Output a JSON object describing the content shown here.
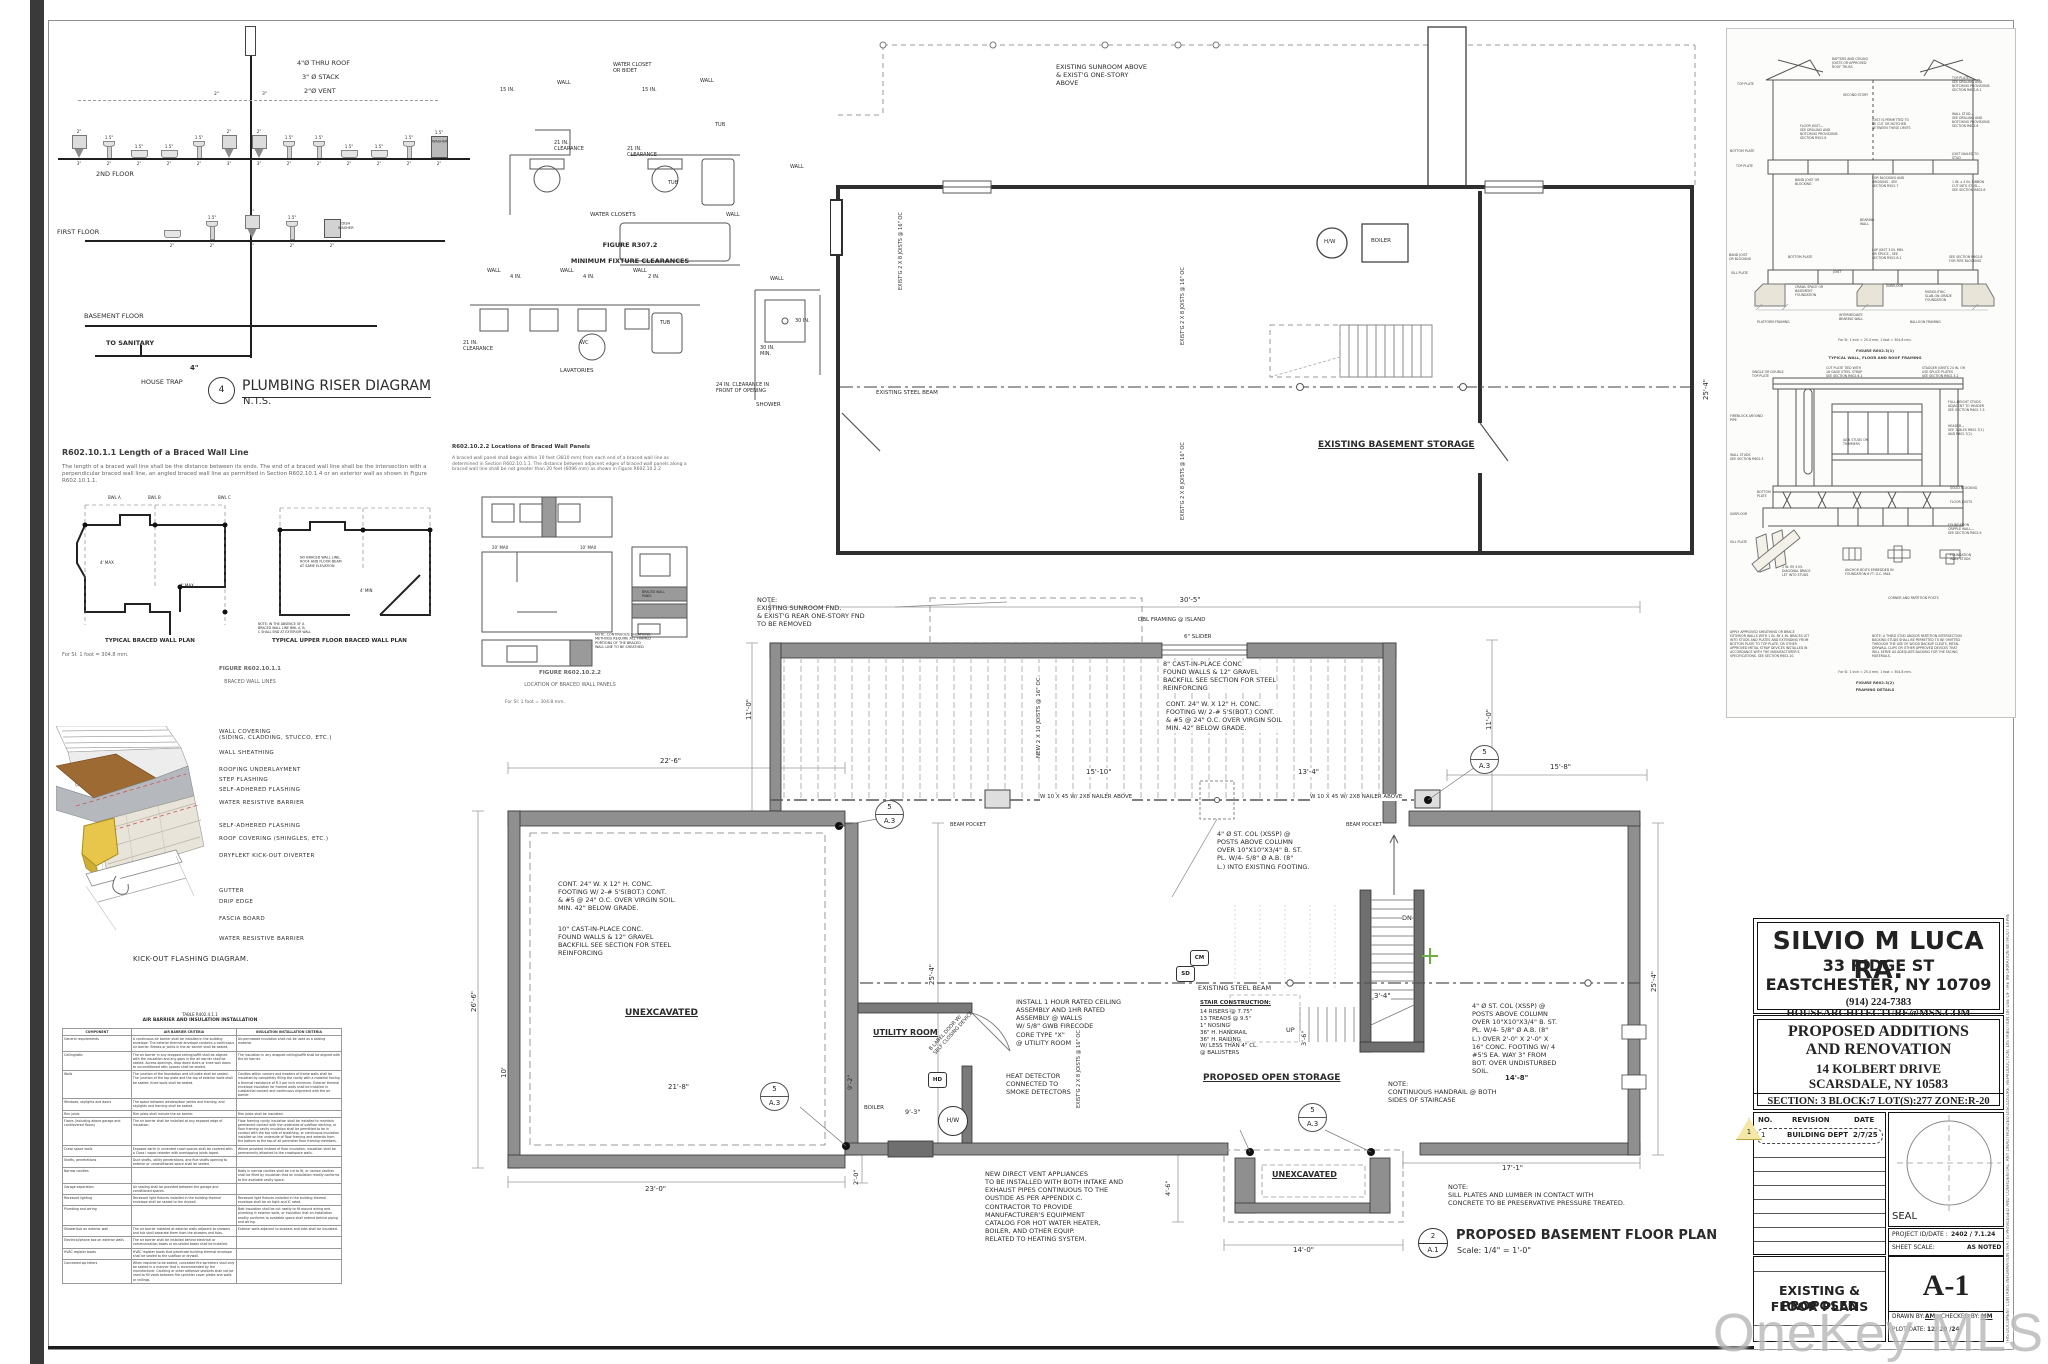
{
  "sheet": {
    "watermark": "OneKey MLS"
  },
  "riser": {
    "number": "4",
    "title": "PLUMBING RISER DIAGRAM",
    "scale": "N.T.S.",
    "thru_roof": "4\"Ø THRU ROOF",
    "stack": "3\" Ø STACK",
    "vent": "2\"Ø VENT",
    "floor2": "2ND FLOOR",
    "floor1": "FIRST FLOOR",
    "floor0": "BASEMENT FLOOR",
    "to_sanitary": "TO SANITARY",
    "house_trap": "HOUSE TRAP",
    "main_size": "4\"",
    "washer": "WASHER",
    "dishwasher": "DISH\nWASHER",
    "hdr2": "2\"",
    "hdr3": "3\"",
    "fix2": [
      {
        "t": "2\"",
        "g": "wc",
        "b": "3\""
      },
      {
        "t": "1.5\"",
        "g": "lav",
        "b": "2\""
      },
      {
        "t": "1.5\"",
        "g": "sink",
        "b": "2\""
      },
      {
        "t": "1.5\"",
        "g": "sink",
        "b": "2\""
      },
      {
        "t": "1.5\"",
        "g": "lav",
        "b": "2\""
      },
      {
        "t": "2\"",
        "g": "wc",
        "b": "3\""
      },
      {
        "t": "2\"",
        "g": "wc",
        "b": "3\""
      },
      {
        "t": "1.5\"",
        "g": "lav",
        "b": "2\""
      },
      {
        "t": "1.5\"",
        "g": "lav",
        "b": "2\""
      },
      {
        "t": "1.5\"",
        "g": "sink",
        "b": "2\""
      },
      {
        "t": "1.5\"",
        "g": "sink",
        "b": "2\""
      },
      {
        "t": "1.5\"",
        "g": "lav",
        "b": "2\""
      },
      {
        "t": "1.5\"",
        "g": "washer",
        "b": "2\""
      }
    ],
    "fix1": [
      {
        "t": "",
        "g": "sink",
        "b": "2\""
      },
      {
        "t": "1.5\"",
        "g": "lav",
        "b": "2\""
      },
      {
        "t": "2\"",
        "g": "wc",
        "b": "3\""
      },
      {
        "t": "1.5\"",
        "g": "lav",
        "b": "2\""
      },
      {
        "t": "",
        "g": "dw",
        "b": "2\""
      }
    ]
  },
  "clear": {
    "fig1": "FIGURE R307.2",
    "fig2": "MINIMUM FIXTURE CLEARANCES",
    "wc_label": "WATER CLOSET\nOR BIDET",
    "wall": "WALL",
    "d15": "15 IN.",
    "clr21": "21 IN.\nCLEARANCE",
    "tub": "TUB",
    "cap_wc": "WATER CLOSETS",
    "d4": "4 IN.",
    "d2": "2 IN.",
    "wc": "WC",
    "cap_lav": "LAVATORIES",
    "d30": "30 IN.",
    "d30m": "30 IN.\nMIN.",
    "front": "24 IN. CLEARANCE IN\nFRONT OF OPENING",
    "cap_sh": "SHOWER"
  },
  "bw1": {
    "head": "R602.10.1.1 Length of a Braced Wall Line",
    "body": "The length of a braced wall line shall be the distance between its ends. The end of a braced wall line shall be the intersection with a perpendicular braced wall line, an angled braced wall line as permitted in Section R602.10.1.4 or an exterior wall as shown in Figure R602.10.1.1.",
    "cap_l": "TYPICAL BRACED WALL PLAN",
    "cap_r": "TYPICAL UPPER FLOOR BRACED WALL PLAN",
    "si": "For SI: 1 foot = 304.8 mm.",
    "fig": "FIGURE R602.10.1.1",
    "figname": "BRACED WALL LINES",
    "bwl_a": "BWL A",
    "bwl_b": "BWL B",
    "bwl_c": "BWL C",
    "max4": "4' MAX",
    "min4": "4' MIN",
    "sp_ab": "SPACING\nBETWEEN\nBWL A-B",
    "sp_bc": "SPACING\nBETWEEN\nBWL B-C",
    "nobwl": "NO BRACED WALL LINE,\nROOF AND FLOOR BEAM\nAT SAME ELEVATION",
    "endnote": "NOTE: IN THE ABSENCE OF A\nBRACED WALL LINE BWL A, B,\nC SHALL END AT EXTERIOR WALL"
  },
  "bw2": {
    "head": "R602.10.2.2 Locations of Braced Wall Panels",
    "body": "A braced wall panel shall begin within 10 feet (3810 mm) from each end of a braced wall line as determined in Section R602.10.1.1. The distance between adjacent edges of braced wall panels along a braced wall line shall be not greater than 20 feet (6096 mm) as shown in Figure R602.10.2.2",
    "max20": "20' MAX",
    "max10": "10' MAX",
    "panel": "BRACED WALL\nPANEL",
    "note": "NOTE: CONTINUOUS SHEATHING\nMETHODS REQUIRE ALL FRAMED\nPORTIONS OF THE BRACED\nWALL LINE TO BE SHEATHED",
    "si": "For SI: 1 foot = 304.8 mm.",
    "fig": "FIGURE R602.10.2.2",
    "figname": "LOCATION OF BRACED WALL PANELS"
  },
  "kick": {
    "labels": [
      "WALL COVERING\n(SIDING, CLADDING, STUCCO, ETC.)",
      "WALL SHEATHING",
      "ROOFING UNDERLAYMENT",
      "STEP FLASHING",
      "SELF-ADHERED FLASHING",
      "WATER RESISTIVE BARRIER",
      "SELF-ADHERED FLASHING",
      "ROOF COVERING (SHINGLES, ETC.)",
      "DRYFLEKT KICK-OUT DIVERTER",
      "GUTTER",
      "DRIP EDGE",
      "FASCIA BOARD",
      "WATER RESISTIVE BARRIER"
    ],
    "caption": "KICK-OUT FLASHING DIAGRAM."
  },
  "air": {
    "title_sm": "TABLE R402.4.1.1",
    "title": "AIR BARRIER AND INSULATION INSTALLATION",
    "headers": [
      "COMPONENT",
      "AIR BARRIER CRITERIA",
      "INSULATION INSTALLATION CRITERIA"
    ],
    "rows": [
      {
        "c": "General requirements",
        "a": "A continuous air barrier shall be installed in the building envelope. The exterior thermal envelope contains a continuous air barrier. Breaks or joints in the air barrier shall be sealed.",
        "i": "Air-permeable insulation shall not be used as a sealing material."
      },
      {
        "c": "Ceiling/attic",
        "a": "The air barrier in any dropped ceiling/soffit shall be aligned with the insulation and any gaps in the air barrier shall be sealed. Access openings, drop down stairs or knee wall doors to unconditioned attic spaces shall be sealed.",
        "i": "The insulation in any dropped ceiling/soffit shall be aligned with the air barrier."
      },
      {
        "c": "Walls",
        "a": "The junction of the foundation and sill plate shall be sealed. The junction of the top plate and the top of exterior walls shall be sealed. Knee walls shall be sealed.",
        "i": "Cavities within corners and headers of frame walls shall be insulated by completely filling the cavity with a material having a thermal resistance of R-3 per inch minimum. Exterior thermal envelope insulation for framed walls shall be installed in substantial contact and continuous alignment with the air barrier."
      },
      {
        "c": "Windows, skylights and doors",
        "a": "The space between window/door jambs and framing, and skylights and framing shall be sealed.",
        "i": ""
      },
      {
        "c": "Rim joists",
        "a": "Rim joists shall include the air barrier.",
        "i": "Rim joists shall be insulated."
      },
      {
        "c": "Floors (including above garage and cantilevered floors)",
        "a": "The air barrier shall be installed at any exposed edge of insulation.",
        "i": "Floor framing cavity insulation shall be installed to maintain permanent contact with the underside of subfloor decking, or floor framing cavity insulation shall be permitted to be in contact with the top side of sheathing, or continuous insulation installed on the underside of floor framing and extends from the bottom to the top of all perimeter floor framing members."
      },
      {
        "c": "Crawl space walls",
        "a": "Exposed earth in unvented crawl spaces shall be covered with a Class I vapor retarder with overlapping joints taped.",
        "i": "Where provided instead of floor insulation, insulation shall be permanently attached to the crawlspace walls."
      },
      {
        "c": "Shafts, penetrations",
        "a": "Duct shafts, utility penetrations, and flue shafts opening to exterior or unconditioned space shall be sealed.",
        "i": ""
      },
      {
        "c": "Narrow cavities",
        "a": "",
        "i": "Batts in narrow cavities shall be cut to fit, or narrow cavities shall be filled by insulation that on installation readily conforms to the available cavity space."
      },
      {
        "c": "Garage separation",
        "a": "Air sealing shall be provided between the garage and conditioned spaces.",
        "i": ""
      },
      {
        "c": "Recessed lighting",
        "a": "Recessed light fixtures installed in the building thermal envelope shall be sealed to the drywall.",
        "i": "Recessed light fixtures installed in the building thermal envelope shall be air tight and IC rated."
      },
      {
        "c": "Plumbing and wiring",
        "a": "",
        "i": "Batt insulation shall be cut neatly to fit around wiring and plumbing in exterior walls, or insulation that on installation readily conforms to available space shall extend behind piping and wiring."
      },
      {
        "c": "Shower/tub on exterior wall",
        "a": "The air barrier installed at exterior walls adjacent to showers and tub shall separate them from the showers and tubs.",
        "i": "Exterior walls adjacent to showers and tubs shall be insulated."
      },
      {
        "c": "Electrical/phone box on exterior walls",
        "a": "The air barrier shall be installed behind electrical or communication boxes or air-sealed boxes shall be installed.",
        "i": ""
      },
      {
        "c": "HVAC register boots",
        "a": "HVAC register boots that penetrate building thermal envelope shall be sealed to the subfloor or drywall.",
        "i": ""
      },
      {
        "c": "Concealed sprinklers",
        "a": "When required to be sealed, concealed fire sprinklers shall only be sealed in a manner that is recommended by the manufacturer. Caulking or other adhesive sealants shall not be used to fill voids between fire sprinkler cover plates and walls or ceilings.",
        "i": ""
      }
    ]
  },
  "ex": {
    "top_note": "EXISTING SUNROOM ABOVE\n& EXIST'G ONE-STORY\nABOVE",
    "hw": "H/W",
    "boiler": "BOILER",
    "beam": "EXISTING STEEL BEAM",
    "room": "EXISTING BASEMENT STORAGE",
    "joists": "EXIST'G 2 X 8 JOISTS\n@ 16\" OC",
    "d254": "25'-4\""
  },
  "pr": {
    "rm_note": "NOTE:\nEXISTING SUNROOM FND.\n& EXIST'G REAR ONE-STORY FND\nTO BE REMOVED",
    "d305": "30'-5\"",
    "d158": "15'-8\"",
    "d110": "11'-0\"",
    "d226": "22'-6\"",
    "d266": "26'-6\"",
    "d254": "25'-4\"",
    "d1510": "15'-10\"",
    "d134": "13'-4\"",
    "d218": "21'-8\"",
    "d10": "10'",
    "d230": "23'-0\"",
    "d20": "2'-0\"",
    "d93": "9'-3\"",
    "d92": "9'-2\"",
    "d46": "4'-6\"",
    "d140": "14'-0\"",
    "d171": "17'-1\"",
    "d34": "3'-4\"",
    "d36": "3'-6\"",
    "d148": "14'-8\"",
    "island": "DBL FRAMING @ ISLAND",
    "slider": "6\" SLIDER",
    "fnd8": "8\" CAST-IN-PLACE CONC\nFOUND WALLS  &  12\" GRAVEL\nBACKFILL SEE SECTION FOR STEEL\nREINFORCING",
    "footing_top": "CONT. 24\" W. X 12\" H. CONC.\nFOOTING W/ 2-# 5'S(BOT.) CONT.\n& #5 @ 24\" O.C. OVER VIRGIN SOIL\nMIN. 42\" BELOW GRADE.",
    "footing_left": "CONT. 24\" W. X 12\" H. CONC.\nFOOTING W/ 2-# 5'S(BOT.) CONT.\n& #5 @ 24\" O.C. OVER VIRGIN SOIL.\nMIN. 42\" BELOW GRADE.",
    "fnd10": "10\" CAST-IN-PLACE CONC.\nFOUND WALLS  & 12\" GRAVEL\nBACKFILL SEE SECTION FOR STEEL\nREINFORCING",
    "joists_new": "NEW 2 X 10 JOISTS\n@ 16\" OC",
    "joists_ex": "EXIST'G 2 X 8 JOISTS\n@ 16\" OC",
    "beam_lbl": "W 10 X 45 W/ 2X8 NAILER ABOVE",
    "pocket": "BEAM POCKET",
    "col_a": "4\" Ø ST. COL (XSSP) @\nPOSTS ABOVE COLUMN\nOVER 10\"X10\"X3/4\" B. ST.\nPL. W/4- 5/8\" Ø A.B. (8\"\nL.) INTO EXISTING FOOTING.",
    "col_b": "4\" Ø ST. COL (XSSP) @\nPOSTS ABOVE COLUMN\nOVER 10\"X10\"X3/4\" B. ST.\nPL. W/4- 5/8\" Ø A.B. (8\"\nL.) OVER 2'-0\" X 2'-0\" X\n16\" CONC. FOOTING W/ 4\n#5'S EA. WAY   3\" FROM\nBOT. OVER UNDISTURBED\nSOIL.",
    "unex": "UNEXCAVATED",
    "utility": "UTILITY ROOM",
    "door_note": "B LABEL DOOR W/\nSELF CLOSING DEVICE",
    "fire_note": "INSTALL 1 HOUR RATED CEILING\nASSEMBLY AND 1HR RATED\nASSEMBLY @ WALLS\nW/ 5/8\" GWB  FIRECODE\nCORE TYPE \"X\"\n@ UTILITY ROOM",
    "hd": "HD",
    "cm": "CM",
    "sd": "SD",
    "hw": "H/W",
    "boiler": "BOILER",
    "up": "UP",
    "dn": "DN",
    "heat_note": "HEAT DETECTOR\nCONNECTED TO\nSMOKE DETECTORS",
    "vent_note": "NEW DIRECT VENT APPLIANCES\nTO BE INSTALLED WITH BOTH INTAKE AND\nEXHAUST PIPES CONTINUOUS TO THE\nOUSTIDE AS PER APPENDIX C.\nCONTRACTOR TO PROVIDE\nMANUFACTURER'S EQUIPMENT\nCATALOG FOR HOT WATER HEATER,\nBOILER, AND OTHER EQUIP.\nRELATED TO HEATING SYSTEM.",
    "beam_ex": "EXISTING STEEL BEAM",
    "stair_head": "STAIR CONSTRUCTION:",
    "stair_body": "14 RISERS @ 7.75\"\n13 TREADS @ 9.5\"\n1\" NOSING\n36\" H. HANDRAIL\n36\" H. RAILING\nW/ LESS THAN 4\" CL.\n@ BALUSTERS",
    "storage": "PROPOSED OPEN STORAGE",
    "handrail_note": "NOTE:\nCONTINUOUS HANDRAIL @ BOTH\nSIDES OF STAIRCASE",
    "sill_note": "NOTE:\nSILL PLATES AND LUMBER IN CONTACT WITH\nCONCRETE TO BE PRESERVATIVE PRESSURE TREATED.",
    "bub_t": "5",
    "bub_b": "A.3",
    "plan_no": "2",
    "plan_sheet": "A.1",
    "title": "PROPOSED BASEMENT FLOOR PLAN",
    "scale": "Scale: 1/4\" = 1'-0\""
  },
  "fr": {
    "f1": [
      "RAFTERS AND CEILING\nJOISTS OR APPROVED\nROOF TRUSS",
      "TOP PLATE",
      "TOP PLATE—\nSEE DRILLING AND\nNOTCHING PROVISIONS\nSECTION R602.6.1",
      "SECOND STORY",
      "WALL STUD—\nSEE DRILLING AND\nNOTCHING PROVISIONS\nSECTION R602.6",
      "FLOOR JOIST—\nSEE DRILLING AND\nNOTCHING PROVISIONS\nSECTION R502.8",
      "JOIST IS PERMITTED TO\nBE CUT OR NOTCHED\nBETWEEN THESE LIMITS",
      "BOTTOM PLATE",
      "TOP PLATE",
      "BAND JOIST OR\nBLOCKING",
      "FOR BLOCKING AND\nBRIDGING - SEE\nSECTION R502.7",
      "JOIST NAILED TO\nSTUD",
      "1 IN. x 4 IN. RIBBON\nCUT INTO STUD—\nSEE SECTION R602.6",
      "BEARING\nWALL",
      "LAP JOIST 3 IN. MIN.\nOR SPLICE - SEE\nSECTION R502.6.1",
      "SEE SECTION R602.8\nFOR FIRE BLOCKING",
      "BAND JOIST\nOR BLOCKING",
      "BOTTOM PLATE",
      "SILL PLATE",
      "JOIST",
      "SUBFLOOR",
      "CRAWL SPACE OR\nBASEMENT\nFOUNDATION",
      "MONOLITHIC\nSLAB-ON-GRADE\nFOUNDATION",
      "INTERMEDIATE\nBEARING WALL",
      "PLATFORM FRAMING",
      "BALLOON FRAMING"
    ],
    "cap1a": "For SI: 1 inch = 25.4 mm, 1 foot = 304.8 mm.",
    "cap1b": "FIGURE R602.3(1)",
    "cap1c": "TYPICAL WALL, FLOOR AND ROOF FRAMING",
    "f2": [
      "SINGLE OR DOUBLE\nTOP PLATE",
      "CUT PLATE TIED WITH\n16 GAGE STEEL STRAP\nSEE SECTION R602.6.1",
      "STAGGER JOINTS 24 IN. OR\nUSE SPLICE PLATES\nSEE SECTION R602.3.2",
      "FULL-HEIGHT STUDS\nADJACENT TO HEADER\nSEE SECTION R602.7.5",
      "FIREBLOCK AROUND\nPIPE",
      "HEADER—\nSEE TABLES R602.7(1)\nAND R602.7(2)",
      "JACK STUDS OR\nTRIMMERS",
      "WALL STUDS\nSEE SECTION R602.3",
      "SOLID BLOCKING",
      "FLOOR JOISTS",
      "BOTTOM\nPLATE",
      "SUBFLOOR",
      "FOUNDATION\nCRIPPLE WALL—\nSEE SECTION R602.9",
      "SILL PLATE",
      "FOUNDATION\nWALL STUDS",
      "1 IN. BY 4 IN.\nDIAGONAL BRACE\nLET INTO STUDS",
      "ANCHOR BOLTS EMBEDDED IN\nFOUNDATION 6 FT. O.C. MAX.",
      "CORNER AND PARTITION POSTS"
    ],
    "note_l": "APPLY APPROVED SHEATHING OR BRACE\nEXTERIOR WALLS WITH 1 IN. BY 4 IN. BRACES LET\nINTO STUDS AND PLATES AND EXTENDING FROM\nBOTTOM PLATE TO TOP PLATE, OR OTHER\nAPPROVED METAL STRAP DEVICES INSTALLED IN\nACCORDANCE WITH THE MANUFACTURER'S\nSPECIFICATIONS. SEE SECTION R602.10.",
    "note_r": "NOTE: A THIRD STUD AND/OR PARTITION INTERSECTION\nBACKING STUDS SHALL BE PERMITTED TO BE OMITTED\nTHROUGH THE USE OF WOOD BACKUP CLEATS, METAL\nDRYWALL CLIPS OR OTHER APPROVED DEVICES THAT\nWILL SERVE AS ADEQUATE BACKING FOR THE FACING\nMATERIALS.",
    "cap2a": "For SI: 1 inch = 25.4 mm, 1 foot = 304.8 mm.",
    "cap2b": "FIGURE R602.3(2)",
    "cap2c": "FRAMING DETAILS"
  },
  "tb": {
    "firm": "SILVIO M LUCA  RA.",
    "a1": "33 RIDGE ST",
    "a2": "EASTCHESTER, NY 10709",
    "contact": "(914) 224-7383    HOUSEARCHITECTURE@MSN.COM",
    "p1": "PROPOSED ADDITIONS",
    "p2": "AND RENOVATION",
    "p3": "14 KOLBERT DRIVE",
    "p4": "SCARSDALE, NY  10583",
    "p5": "SECTION: 3   BLOCK:7    LOT(S):277   ZONE:R-20",
    "rev_no": "NO.",
    "rev": "REVISION",
    "date": "DATE",
    "r1n": "1",
    "r1": "BUILDING DEPT",
    "r1d": "2/7/25",
    "tri": "1",
    "seal": "SEAL",
    "pid_l": "PROJECT ID/DATE :",
    "pid_v": "2402 / 7.1.24",
    "ss_l": "SHEET SCALE:",
    "ss_v": "AS NOTED",
    "st1": "EXISTING & PROPOSED",
    "st2": "FLOOR PLANS",
    "no": "A-1",
    "drawn_l": "DRAWN BY:",
    "drawn_v": "AM",
    "chk_l": "CHECKED BY:",
    "chk_v": "MM",
    "plot_l": "PLOT DATE:",
    "plot_v": "12/ 20 /24",
    "side": "THIS DOCUMENT CONTAINS INFORMATION THAT IS PRIVILEGED AND CONFIDENTIAL. ANY UNAUTHORIZED DISCLOSURE, REPRODUCTION, DISTRIBUTION OR USE OF THE INFORMATION WITHOUT EXPRESS WRITTEN AUTHORIZATION IS STRICTLY PROHIBITED."
  }
}
